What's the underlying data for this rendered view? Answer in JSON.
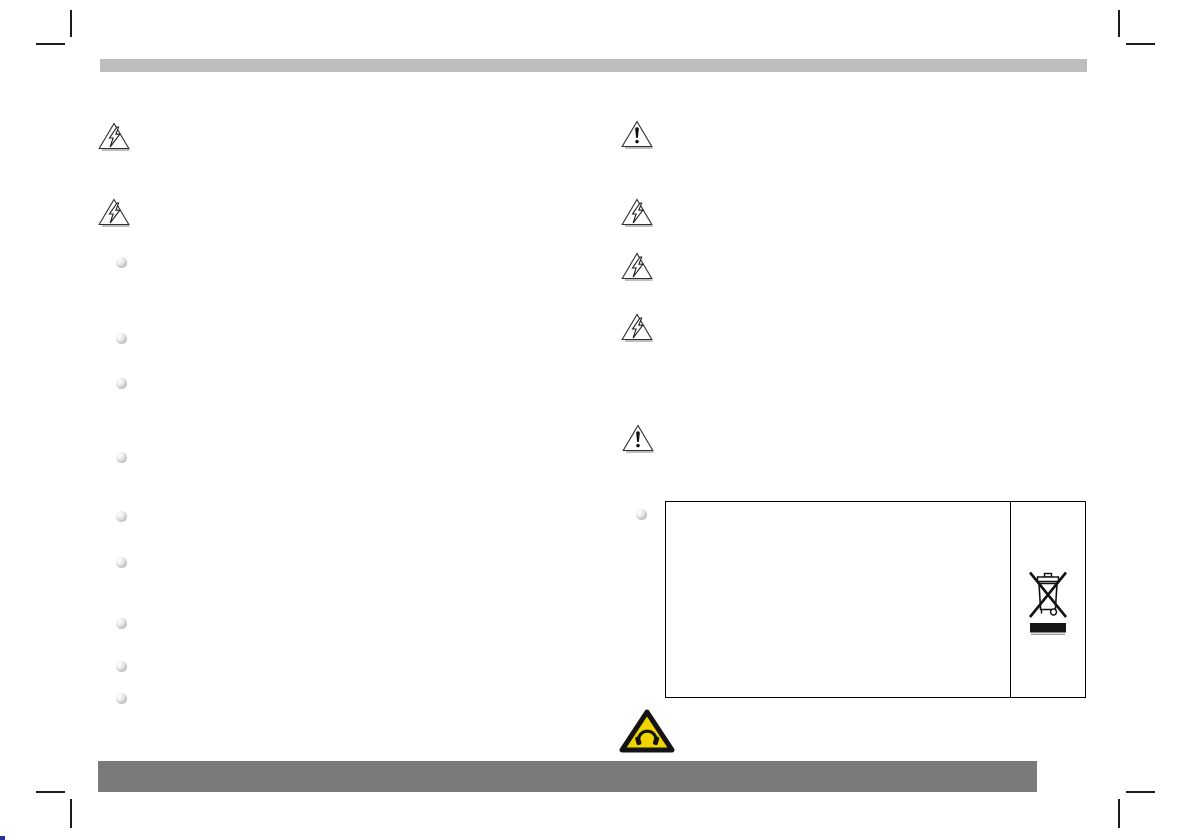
{
  "symbols": {
    "left_column": [
      {
        "icon": "high-voltage-warning-icon",
        "x": 98,
        "y": 121
      },
      {
        "icon": "high-voltage-warning-icon",
        "x": 98,
        "y": 197
      }
    ],
    "right_column": [
      {
        "icon": "general-warning-icon",
        "x": 621,
        "y": 119
      },
      {
        "icon": "high-voltage-warning-icon",
        "x": 621,
        "y": 197
      },
      {
        "icon": "high-voltage-warning-icon",
        "x": 621,
        "y": 251
      },
      {
        "icon": "high-voltage-warning-icon",
        "x": 621,
        "y": 312
      },
      {
        "icon": "general-warning-icon",
        "x": 622,
        "y": 423
      }
    ]
  },
  "bullets": {
    "left_column": {
      "x": 116,
      "y_positions": [
        257,
        333,
        378,
        452,
        511,
        557,
        618,
        661,
        693
      ]
    },
    "right_column": {
      "x": 636,
      "y_positions": [
        509
      ]
    }
  },
  "weee_table": {
    "left_cell_text": "",
    "symbol": "weee-crossed-out-wheeled-bin-icon"
  },
  "footer_symbol": "hearing-damage-warning-icon",
  "colors": {
    "header_bar": "#bdbdbd",
    "footer_bar": "#7a7a7a",
    "crop_marks": "#1d1d1d",
    "bullet": "#c9c9c9",
    "table_border": "#000000",
    "warning_triangle_yellow": "#f0d400",
    "registration_mark": "#2a2f9e"
  }
}
